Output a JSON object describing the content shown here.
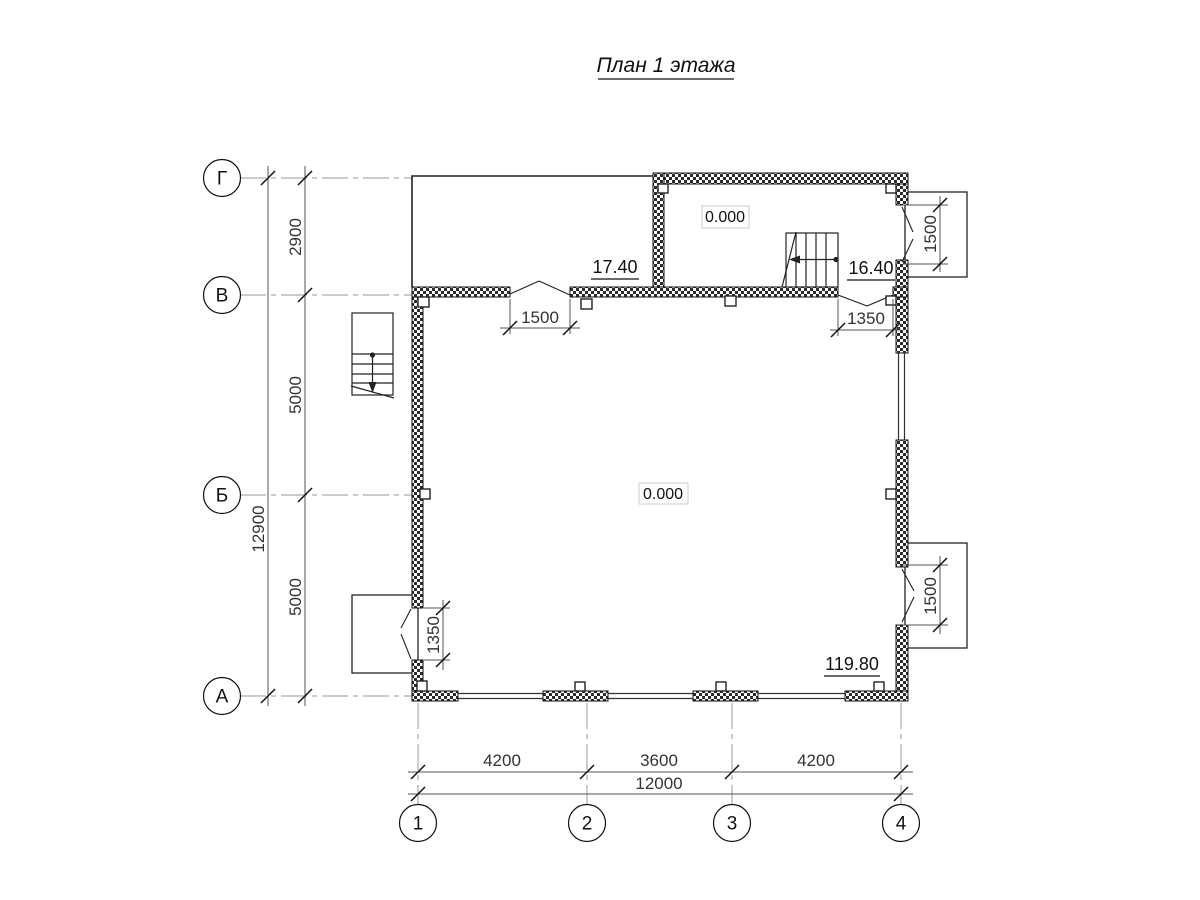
{
  "title": "План 1 этажа",
  "grid": {
    "rows": [
      {
        "label": "Г"
      },
      {
        "label": "В"
      },
      {
        "label": "Б"
      },
      {
        "label": "А"
      }
    ],
    "cols": [
      {
        "label": "1"
      },
      {
        "label": "2"
      },
      {
        "label": "3"
      },
      {
        "label": "4"
      }
    ]
  },
  "dims": {
    "left": {
      "segments": [
        "2900",
        "5000",
        "5000"
      ],
      "total": "12900"
    },
    "bottom": {
      "segments": [
        "4200",
        "3600",
        "4200"
      ],
      "total": "12000"
    },
    "openings": {
      "entry_top": "1500",
      "entry_top_right": "1350",
      "porch_top_right": "1500",
      "porch_bottom_right": "1500",
      "porch_bottom_left": "1350"
    }
  },
  "labels": {
    "level_entry": "0.000",
    "level_main": "0.000",
    "area_room_left": "17.40",
    "area_room_right": "16.40",
    "area_main": "119.80"
  },
  "colors": {
    "paper": "#ffffff",
    "line": "#111111",
    "axis_line": "#999999",
    "dim_line": "#555555",
    "wall_hatch": "#2b2b2b",
    "label_box_border": "#cccccc"
  }
}
